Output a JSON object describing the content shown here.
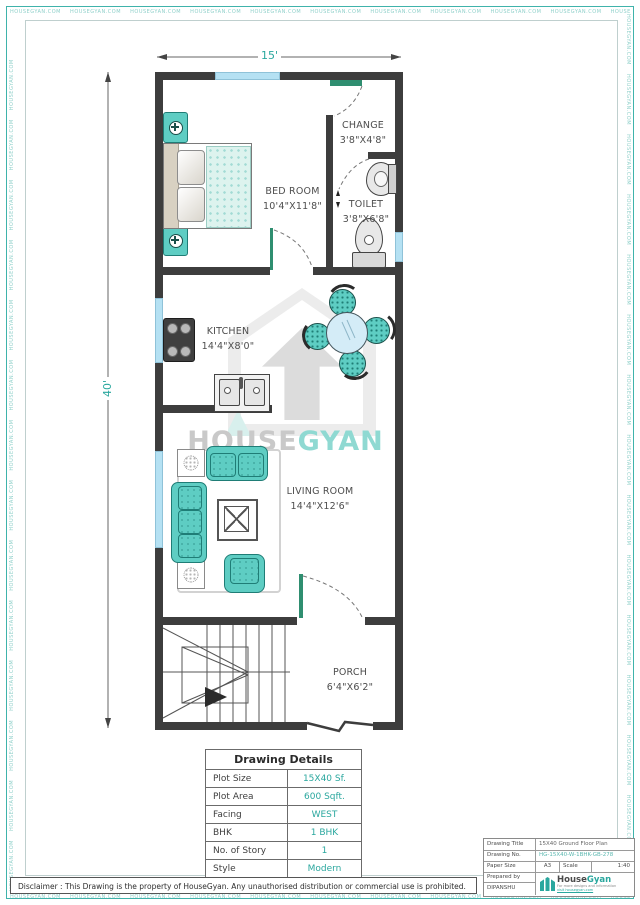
{
  "watermark_strip": "HOUSEGYAN.COM",
  "colors": {
    "accent_teal": "#2aa79e",
    "furniture_teal": "#5ecdc3",
    "window_blue": "#b5e1f3",
    "wall_dark": "#3d3d3d"
  },
  "plan": {
    "dim_width": "15'",
    "dim_height": "40'",
    "rooms": [
      {
        "name": "BED ROOM",
        "size": "10'4\"X11'8\""
      },
      {
        "name": "CHANGE",
        "size": "3'8\"X4'8\""
      },
      {
        "name": "TOILET",
        "size": "3'8\"X6'8\""
      },
      {
        "name": "KITCHEN",
        "size": "14'4\"X8'0\""
      },
      {
        "name": "LIVING ROOM",
        "size": "14'4\"X12'6\""
      },
      {
        "name": "PORCH",
        "size": "6'4\"X6'2\""
      }
    ],
    "watermark": {
      "part1": "HOUSE",
      "part2": "GYAN"
    }
  },
  "details_table": {
    "title": "Drawing Details",
    "rows": [
      {
        "label": "Plot Size",
        "value": "15X40 Sf."
      },
      {
        "label": "Plot Area",
        "value": "600 Sqft."
      },
      {
        "label": "Facing",
        "value": "WEST"
      },
      {
        "label": "BHK",
        "value": "1 BHK"
      },
      {
        "label": "No. of Story",
        "value": "1"
      },
      {
        "label": "Style",
        "value": "Modern"
      }
    ]
  },
  "title_block": {
    "drawing_title_label": "Drawing Title",
    "drawing_title": "15X40 Ground Floor Plan",
    "drawing_no_label": "Drawing No.",
    "drawing_no": "HG-15X40-W-1BHK-GB-278",
    "paper_size_label": "Paper Size",
    "paper_size": "A3",
    "scale_label": "Scale",
    "scale": "1:40",
    "prepared_by_label": "Prepared by",
    "prepared_by": "DIPANSHU",
    "logo": {
      "part1": "House",
      "part2": "Gyan",
      "tagline1": "For more designs and information",
      "tagline2": "visit housegyan.com"
    }
  },
  "disclaimer": "Disclaimer : This Drawing is the property of HouseGyan. Any unauthorised distribution or commercial use is prohibited."
}
